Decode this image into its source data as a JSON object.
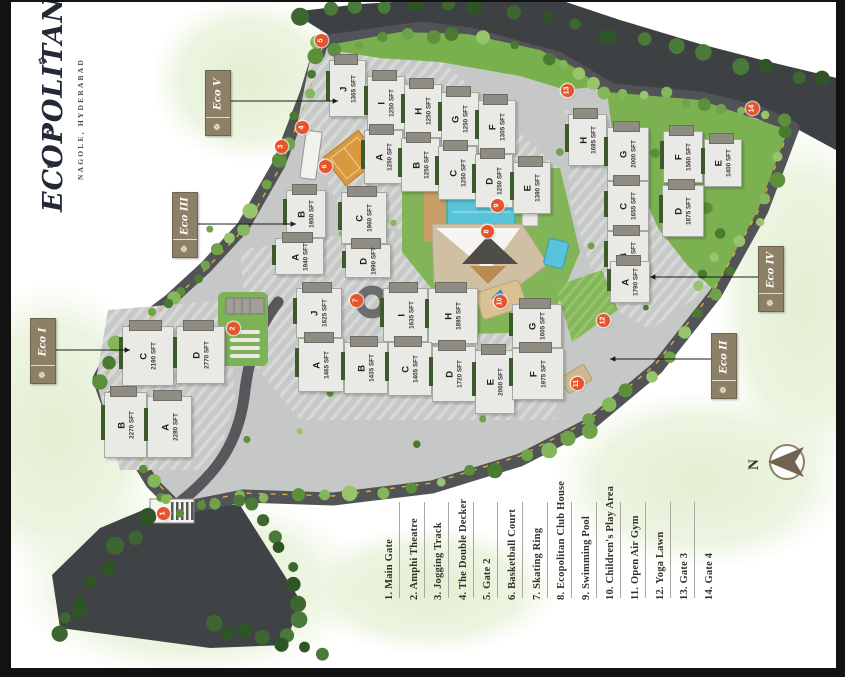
{
  "logo": {
    "name": "ECOPOLITAN",
    "location": "NAGOLE, HYDERABAD"
  },
  "icons": {
    "flower": "✿",
    "zone_leaf": "❁"
  },
  "compass": {
    "north_label": "N"
  },
  "zones": [
    {
      "id": "eco-5",
      "label": "Eco V",
      "box": {
        "x": 205,
        "y": 70,
        "w": 24,
        "h": 64
      },
      "arrow": {
        "x1": 229,
        "y1": 101,
        "x2": 338,
        "y2": 101
      }
    },
    {
      "id": "eco-3",
      "label": "Eco III",
      "box": {
        "x": 172,
        "y": 192,
        "w": 24,
        "h": 64
      },
      "arrow": {
        "x1": 196,
        "y1": 224,
        "x2": 296,
        "y2": 224
      }
    },
    {
      "id": "eco-1",
      "label": "Eco I",
      "box": {
        "x": 30,
        "y": 318,
        "w": 24,
        "h": 64
      },
      "arrow": {
        "x1": 54,
        "y1": 350,
        "x2": 130,
        "y2": 350
      }
    },
    {
      "id": "eco-4",
      "label": "Eco IV",
      "box": {
        "x": 758,
        "y": 246,
        "w": 24,
        "h": 64
      },
      "arrow": {
        "x1": 758,
        "y1": 277,
        "x2": 650,
        "y2": 277
      }
    },
    {
      "id": "eco-2",
      "label": "Eco II",
      "box": {
        "x": 711,
        "y": 333,
        "w": 24,
        "h": 64
      },
      "arrow": {
        "x1": 711,
        "y1": 359,
        "x2": 610,
        "y2": 359
      }
    }
  ],
  "clusters": [
    {
      "id": "eco-5",
      "towers": [
        {
          "name": "J",
          "area": "1365 SFT",
          "x": 329,
          "y": 60,
          "w": 35,
          "h": 55
        },
        {
          "name": "I",
          "area": "1250 SFT",
          "x": 367,
          "y": 76,
          "w": 36,
          "h": 52
        },
        {
          "name": "H",
          "area": "1250 SFT",
          "x": 404,
          "y": 84,
          "w": 36,
          "h": 52
        },
        {
          "name": "G",
          "area": "1250 SFT",
          "x": 441,
          "y": 92,
          "w": 36,
          "h": 52
        },
        {
          "name": "F",
          "area": "1305 SFT",
          "x": 478,
          "y": 100,
          "w": 36,
          "h": 52
        },
        {
          "name": "A",
          "area": "1250 SFT",
          "x": 364,
          "y": 130,
          "w": 37,
          "h": 52
        },
        {
          "name": "B",
          "area": "1250 SFT",
          "x": 401,
          "y": 138,
          "w": 37,
          "h": 52
        },
        {
          "name": "C",
          "area": "1250 SFT",
          "x": 438,
          "y": 146,
          "w": 37,
          "h": 52
        },
        {
          "name": "D",
          "area": "1250 SFT",
          "x": 475,
          "y": 154,
          "w": 36,
          "h": 52
        },
        {
          "name": "E",
          "area": "1390 SFT",
          "x": 513,
          "y": 162,
          "w": 36,
          "h": 50
        }
      ]
    },
    {
      "id": "eco-4",
      "towers": [
        {
          "name": "H",
          "area": "1685 SFT",
          "x": 568,
          "y": 114,
          "w": 37,
          "h": 50
        },
        {
          "name": "G",
          "area": "2000 SFT",
          "x": 607,
          "y": 127,
          "w": 40,
          "h": 52
        },
        {
          "name": "F",
          "area": "1560 SFT",
          "x": 663,
          "y": 131,
          "w": 38,
          "h": 50
        },
        {
          "name": "E",
          "area": "1400 SFT",
          "x": 704,
          "y": 139,
          "w": 36,
          "h": 46
        },
        {
          "name": "C",
          "area": "1655 SFT",
          "x": 607,
          "y": 181,
          "w": 40,
          "h": 48
        },
        {
          "name": "D",
          "area": "1875 SFT",
          "x": 662,
          "y": 185,
          "w": 40,
          "h": 50
        },
        {
          "name": "B",
          "area": "1580 SFT",
          "x": 607,
          "y": 231,
          "w": 40,
          "h": 48
        },
        {
          "name": "A",
          "area": "1790 SFT",
          "x": 610,
          "y": 261,
          "w": 38,
          "h": 40
        }
      ]
    },
    {
      "id": "eco-3",
      "towers": [
        {
          "name": "B",
          "area": "1950 SFT",
          "x": 286,
          "y": 190,
          "w": 38,
          "h": 46
        },
        {
          "name": "C",
          "area": "1960 SFT",
          "x": 341,
          "y": 192,
          "w": 44,
          "h": 50
        },
        {
          "name": "A",
          "area": "1940 SFT",
          "x": 275,
          "y": 238,
          "w": 47,
          "h": 35
        },
        {
          "name": "D",
          "area": "1990 SFT",
          "x": 345,
          "y": 244,
          "w": 44,
          "h": 32
        }
      ]
    },
    {
      "id": "eco-1",
      "towers": [
        {
          "name": "C",
          "area": "2190 SFT",
          "x": 122,
          "y": 326,
          "w": 50,
          "h": 58
        },
        {
          "name": "D",
          "area": "2770 SFT",
          "x": 176,
          "y": 326,
          "w": 47,
          "h": 56
        },
        {
          "name": "B",
          "area": "2270 SFT",
          "x": 104,
          "y": 392,
          "w": 41,
          "h": 64
        },
        {
          "name": "A",
          "area": "2280 SFT",
          "x": 147,
          "y": 396,
          "w": 43,
          "h": 60
        }
      ]
    },
    {
      "id": "eco-2",
      "towers": [
        {
          "name": "J",
          "area": "1625 SFT",
          "x": 296,
          "y": 288,
          "w": 44,
          "h": 48
        },
        {
          "name": "I",
          "area": "1635 SFT",
          "x": 383,
          "y": 288,
          "w": 43,
          "h": 52
        },
        {
          "name": "H",
          "area": "1895 SFT",
          "x": 428,
          "y": 288,
          "w": 48,
          "h": 54
        },
        {
          "name": "G",
          "area": "1605 SFT",
          "x": 512,
          "y": 304,
          "w": 48,
          "h": 42
        },
        {
          "name": "A",
          "area": "1465 SFT",
          "x": 298,
          "y": 338,
          "w": 44,
          "h": 52
        },
        {
          "name": "B",
          "area": "1435 SFT",
          "x": 344,
          "y": 342,
          "w": 42,
          "h": 50
        },
        {
          "name": "C",
          "area": "1405 SFT",
          "x": 388,
          "y": 342,
          "w": 42,
          "h": 52
        },
        {
          "name": "D",
          "area": "1720 SFT",
          "x": 432,
          "y": 346,
          "w": 42,
          "h": 54
        },
        {
          "name": "E",
          "area": "2060 SFT",
          "x": 475,
          "y": 350,
          "w": 38,
          "h": 62
        },
        {
          "name": "F",
          "area": "1975 SFT",
          "x": 512,
          "y": 348,
          "w": 50,
          "h": 50
        }
      ]
    }
  ],
  "markers": [
    {
      "num": "1",
      "x": 163,
      "y": 513
    },
    {
      "num": "2",
      "x": 233,
      "y": 328
    },
    {
      "num": "3",
      "x": 281,
      "y": 146
    },
    {
      "num": "4",
      "x": 302,
      "y": 127
    },
    {
      "num": "5",
      "x": 321,
      "y": 40
    },
    {
      "num": "6",
      "x": 325,
      "y": 166
    },
    {
      "num": "7",
      "x": 356,
      "y": 300
    },
    {
      "num": "8",
      "x": 487,
      "y": 231
    },
    {
      "num": "9",
      "x": 497,
      "y": 205
    },
    {
      "num": "10",
      "x": 500,
      "y": 301
    },
    {
      "num": "11",
      "x": 577,
      "y": 383
    },
    {
      "num": "12",
      "x": 603,
      "y": 320
    },
    {
      "num": "13",
      "x": 567,
      "y": 90
    },
    {
      "num": "14",
      "x": 752,
      "y": 108
    }
  ],
  "legend": {
    "items": [
      {
        "num": "1.",
        "label": "Main Gate"
      },
      {
        "num": "2.",
        "label": "Amphi Theatre"
      },
      {
        "num": "3.",
        "label": "Jogging Track"
      },
      {
        "num": "4.",
        "label": "The Double Decker"
      },
      {
        "num": "5.",
        "label": "Gate 2"
      },
      {
        "num": "6.",
        "label": "Basketball Court"
      },
      {
        "num": "7.",
        "label": "Skating Ring"
      },
      {
        "num": "8.",
        "label": "Ecopolitan Club House"
      },
      {
        "num": "9.",
        "label": "Swimming Pool"
      },
      {
        "num": "10.",
        "label": "Children's Play Area"
      },
      {
        "num": "11.",
        "label": "Open Air Gym"
      },
      {
        "num": "12.",
        "label": "Yoga Lawn"
      },
      {
        "num": "13.",
        "label": "Gate 3"
      },
      {
        "num": "14.",
        "label": "Gate 4"
      }
    ]
  }
}
